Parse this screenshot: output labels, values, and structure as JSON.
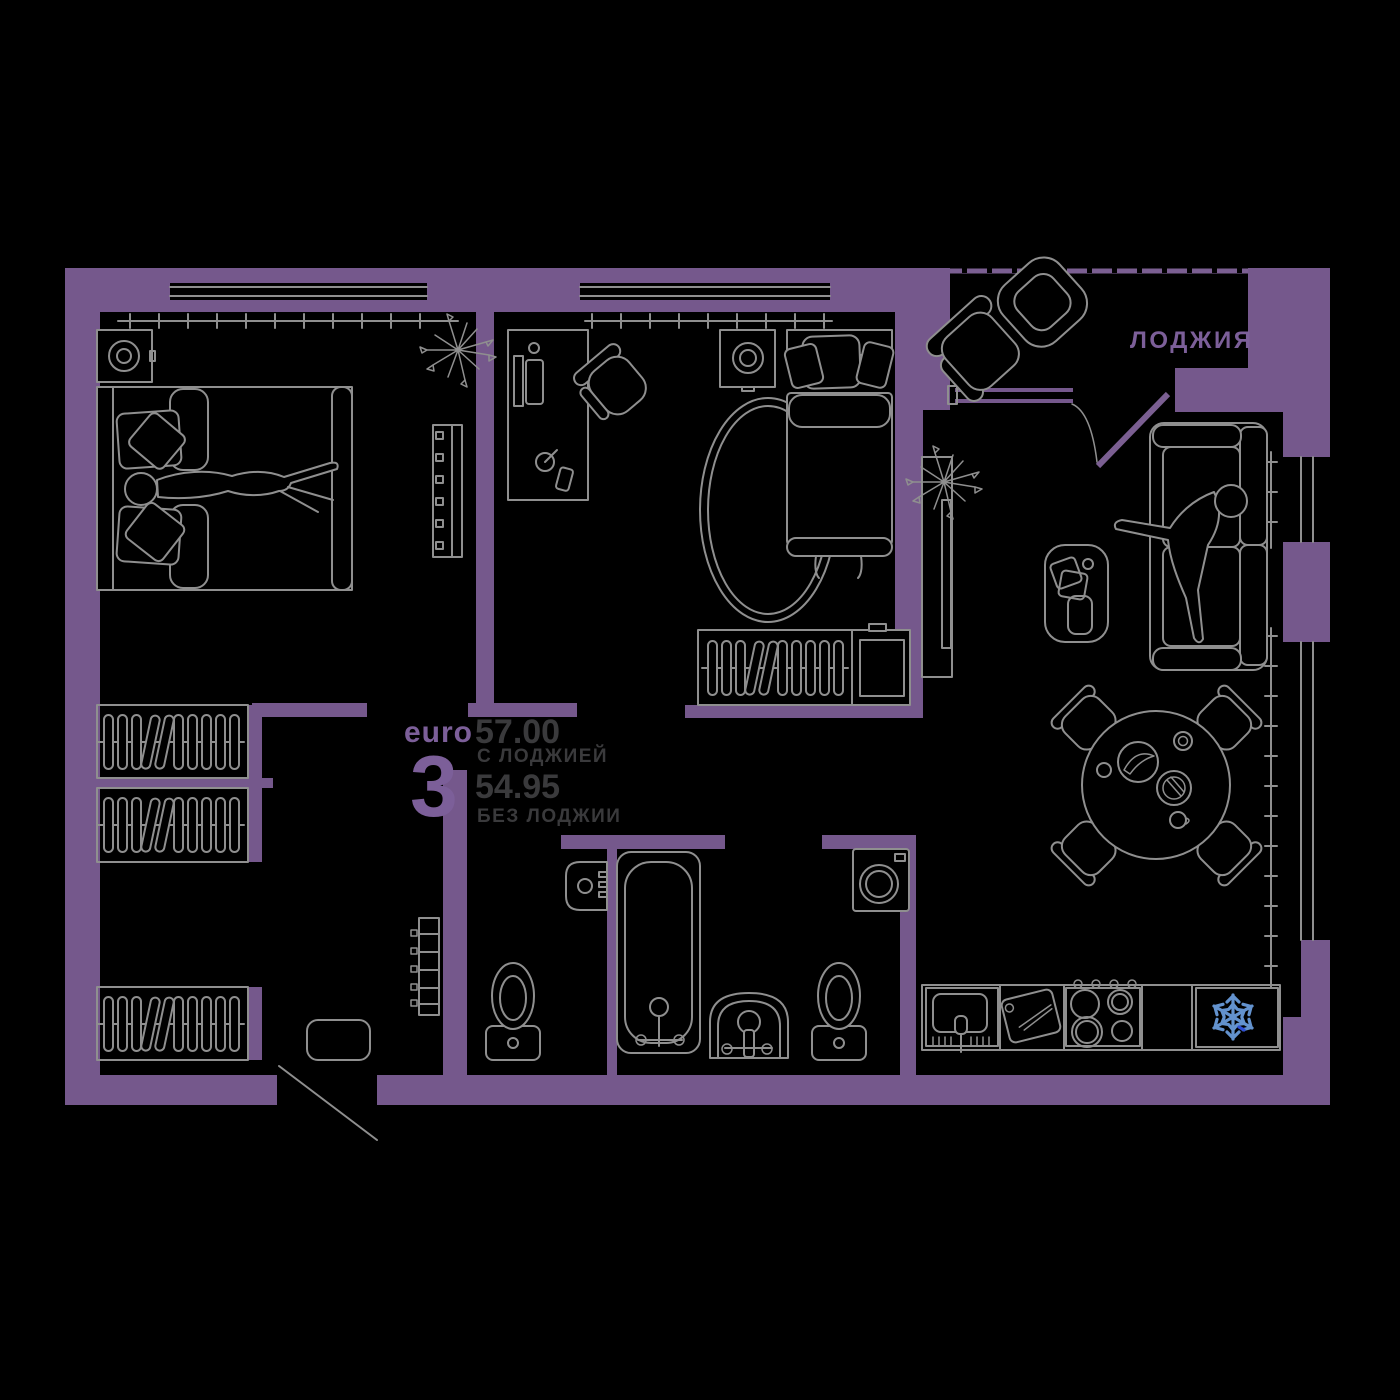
{
  "unit": {
    "series_label": "euro",
    "rooms_count": "3"
  },
  "areas": {
    "with_loggia": {
      "value": "57.00",
      "label": "С ЛОДЖИЕЙ"
    },
    "without_loggia": {
      "value": "54.95",
      "label": "БЕЗ ЛОДЖИИ"
    }
  },
  "room_labels": {
    "loggia": "ЛОДЖИЯ"
  },
  "icons": {
    "refrigerator": "snowflake-icon"
  },
  "colors": {
    "background": "#000000",
    "wall": "#75588C",
    "wall_accent": "#7B5F92",
    "line": "#8F8F8F",
    "text_dark": "#3A3A3C",
    "text_purple": "#7C5F99",
    "snowflake": "#6392CE",
    "snowflake_accent": "#2F4FD4"
  }
}
